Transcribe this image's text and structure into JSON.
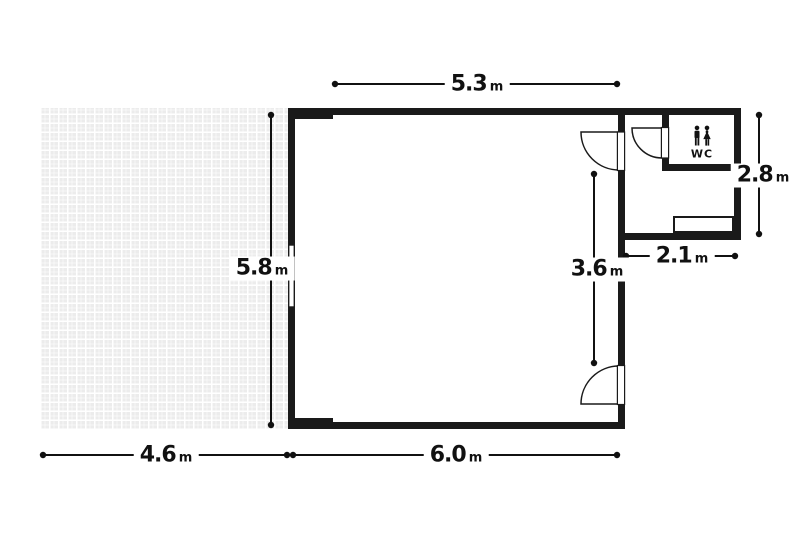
{
  "plan": {
    "wc_label": "WC",
    "dims": {
      "top_width": {
        "value": "5.3",
        "unit": "m"
      },
      "left_height": {
        "value": "5.8",
        "unit": "m"
      },
      "right_segment": {
        "value": "3.6",
        "unit": "m"
      },
      "wc_height": {
        "value": "2.8",
        "unit": "m"
      },
      "wc_width": {
        "value": "2.1",
        "unit": "m"
      },
      "terrace_width": {
        "value": "4.6",
        "unit": "m"
      },
      "room_width": {
        "value": "6.0",
        "unit": "m"
      }
    },
    "colors": {
      "wall": "#1a1a1a",
      "tile": "#ececec",
      "line": "#111111",
      "background": "#ffffff"
    }
  }
}
